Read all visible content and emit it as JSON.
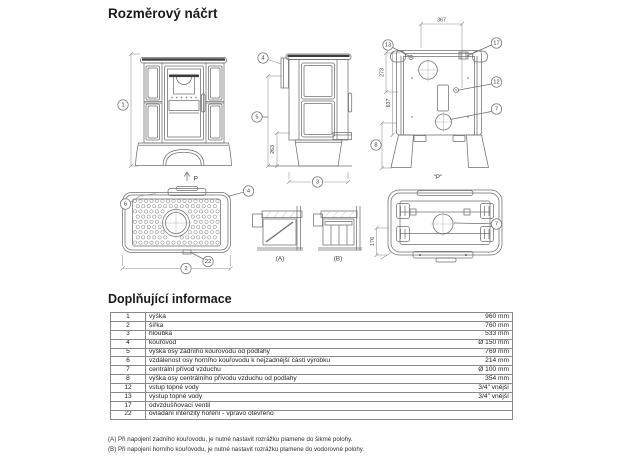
{
  "page": {
    "title": "Rozměrový náčrt",
    "section_title": "Doplňující informace"
  },
  "colors": {
    "text": "#1a1a1a",
    "drawing_lines": "#6f6f6f",
    "table_border": "#8a8a8a"
  },
  "drawing": {
    "front": {
      "marker_height": "1",
      "direction_label": "P"
    },
    "side": {
      "marker_flue": "4",
      "marker_flue_height": "5",
      "dim_263": "263",
      "marker_depth": "3"
    },
    "rear": {
      "dim_367": "367",
      "dim_273": "273",
      "dim_637": "637",
      "marker_13": "13",
      "marker_17": "17",
      "marker_12": "12",
      "marker_7": "7",
      "marker_8": "8",
      "view_label": "\"P\""
    },
    "top": {
      "marker_6": "6",
      "marker_4": "4",
      "marker_22": "22",
      "marker_2": "2"
    },
    "details": {
      "label_a": "(A)",
      "label_b": "(B)"
    },
    "bottom": {
      "marker_7": "7",
      "dim_176": "176"
    }
  },
  "table": {
    "rows": [
      {
        "num": "1",
        "desc": "výška",
        "value": "960 mm"
      },
      {
        "num": "2",
        "desc": "šířka",
        "value": "760 mm"
      },
      {
        "num": "3",
        "desc": "hloubka",
        "value": "533 mm"
      },
      {
        "num": "4",
        "desc": "kouřovod",
        "value": "Ø 150 mm"
      },
      {
        "num": "5",
        "desc": "výška osy zadního kouřovodu od podlahy",
        "value": "769 mm"
      },
      {
        "num": "6",
        "desc": "vzdálenost osy horního kouřovodu k nejzadnější části výrobku",
        "value": "214 mm"
      },
      {
        "num": "7",
        "desc": "centrální přívod vzduchu",
        "value": "Ø 100 mm"
      },
      {
        "num": "8",
        "desc": "výška osy centrálního přívodu vzduchu od podlahy",
        "value": "354 mm"
      },
      {
        "num": "12",
        "desc": "vstup topné vody",
        "value": "3/4\" vnější"
      },
      {
        "num": "13",
        "desc": "výstup topné vody",
        "value": "3/4\" vnější"
      },
      {
        "num": "17",
        "desc": "odvzdušňovací ventil",
        "value": ""
      },
      {
        "num": "22",
        "desc": "ovládání intenzity hoření - vpravo otevřeno",
        "value": ""
      }
    ]
  },
  "footnotes": [
    "(A) Při napojení zadního kouřovodu, je nutné nastavit rozrážku plamene do šikmé polohy.",
    "(B) Při napojení horního kouřovodu, je nutné nastavit rozrážku plamene do vodorovné polohy."
  ]
}
